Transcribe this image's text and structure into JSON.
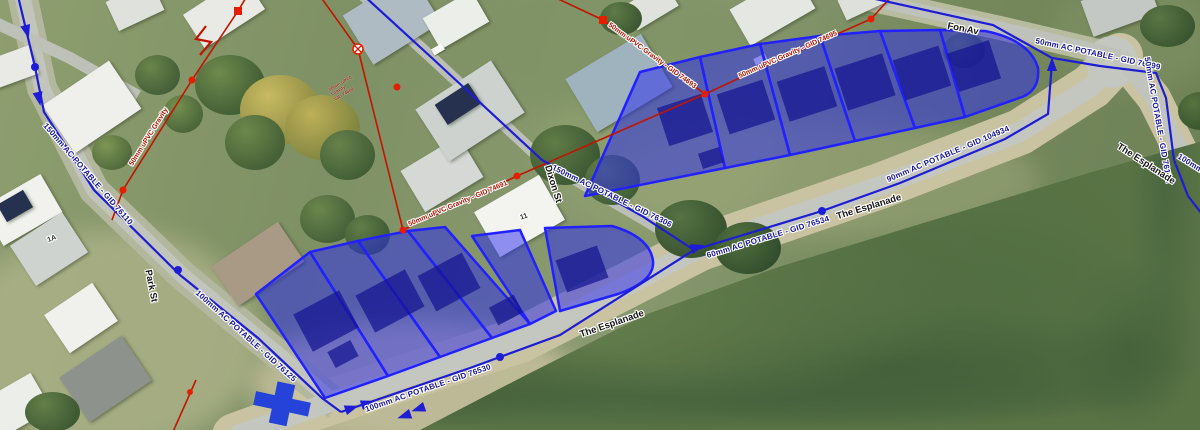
{
  "streets": {
    "park_st": "Park St",
    "dixon_st": "Dixon St",
    "fon_av": "Fon Av",
    "esplanade_west": "The Esplanade",
    "esplanade_mid": "The Esplanade",
    "esplanade_east": "The Esplanade"
  },
  "water": {
    "w1": "150mm AC POTABLE - GID 76110",
    "w2": "100mm AC POTABLE - GID 76125",
    "w3": "100mm AC POTABLE - GID 76530",
    "w4": "60mm AC POTABLE - GID 76534",
    "w5": "90mm AC POTABLE - GID 104934",
    "w6": "150mm AC POTABLE - GID 76306",
    "w7": "50mm AC POTABLE - GID 76199",
    "w8": "50mm AC POTABLE - GID 76171",
    "w9": "100mm AC POTABLE"
  },
  "sewer": {
    "s1": "50mm uPVC Gravity - GID 74691",
    "s2": "50mm uPVC Gravity - GID 74693",
    "s3": "50mm uPVC Gravity - GID 74695",
    "s4": "50mm uPVC Gravity"
  },
  "houses": {
    "h1a": "1A",
    "h11": "11"
  },
  "notes": {
    "line1": "50mm uPVC",
    "line2": "Gravity",
    "line3": "GID 74689"
  },
  "icons": {
    "flow_arrow": "flow-arrow-icon",
    "node": "node-marker-icon",
    "cross": "cross-marker-icon",
    "circle_x": "sewer-fitting-icon"
  },
  "colors": {
    "water_main": "#1d1dd6",
    "sewer_main": "#c01500",
    "parcel_fill": "rgba(40,40,240,0.5)",
    "parcel_stroke": "#2121ff",
    "water_label": "#14149b",
    "sewer_label": "#b01300"
  }
}
